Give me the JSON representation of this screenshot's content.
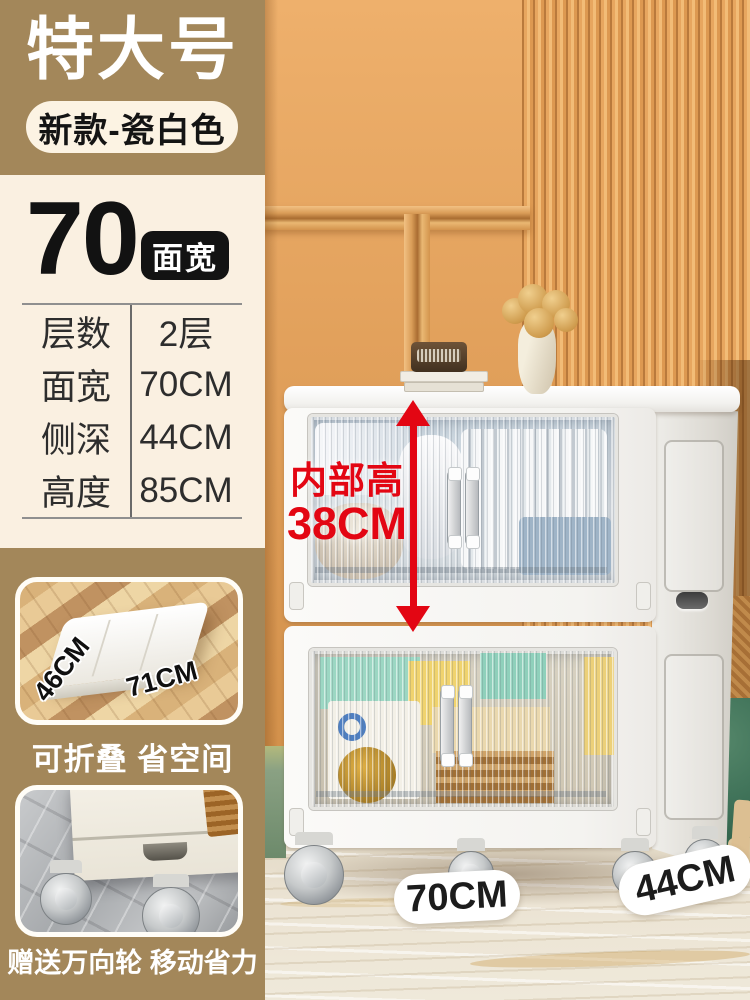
{
  "header": {
    "size_label": "特大号",
    "variant_badge": "新款-瓷白色"
  },
  "spec": {
    "width_number": "70",
    "width_badge": "面宽",
    "rows": [
      {
        "label": "层数",
        "value": "2层"
      },
      {
        "label": "面宽",
        "value": "70CM"
      },
      {
        "label": "侧深",
        "value": "44CM"
      },
      {
        "label": "高度",
        "value": "85CM"
      }
    ]
  },
  "features": [
    {
      "caption": "可折叠 省空间",
      "dim_labels": [
        "46CM",
        "71CM"
      ]
    },
    {
      "caption": "赠送万向轮 移动省力"
    }
  ],
  "annotations": {
    "inner_height_line1": "内部高",
    "inner_height_line2": "38CM",
    "floor_width_label": "70CM",
    "floor_depth_label": "44CM"
  },
  "colors": {
    "tan_block": "#a3875a",
    "cream_panel": "#faf0e1",
    "accent_red": "#e30613",
    "badge_black": "#131313",
    "wall_orange": "#e2a15c",
    "pouf_green": "#3c6f56"
  }
}
